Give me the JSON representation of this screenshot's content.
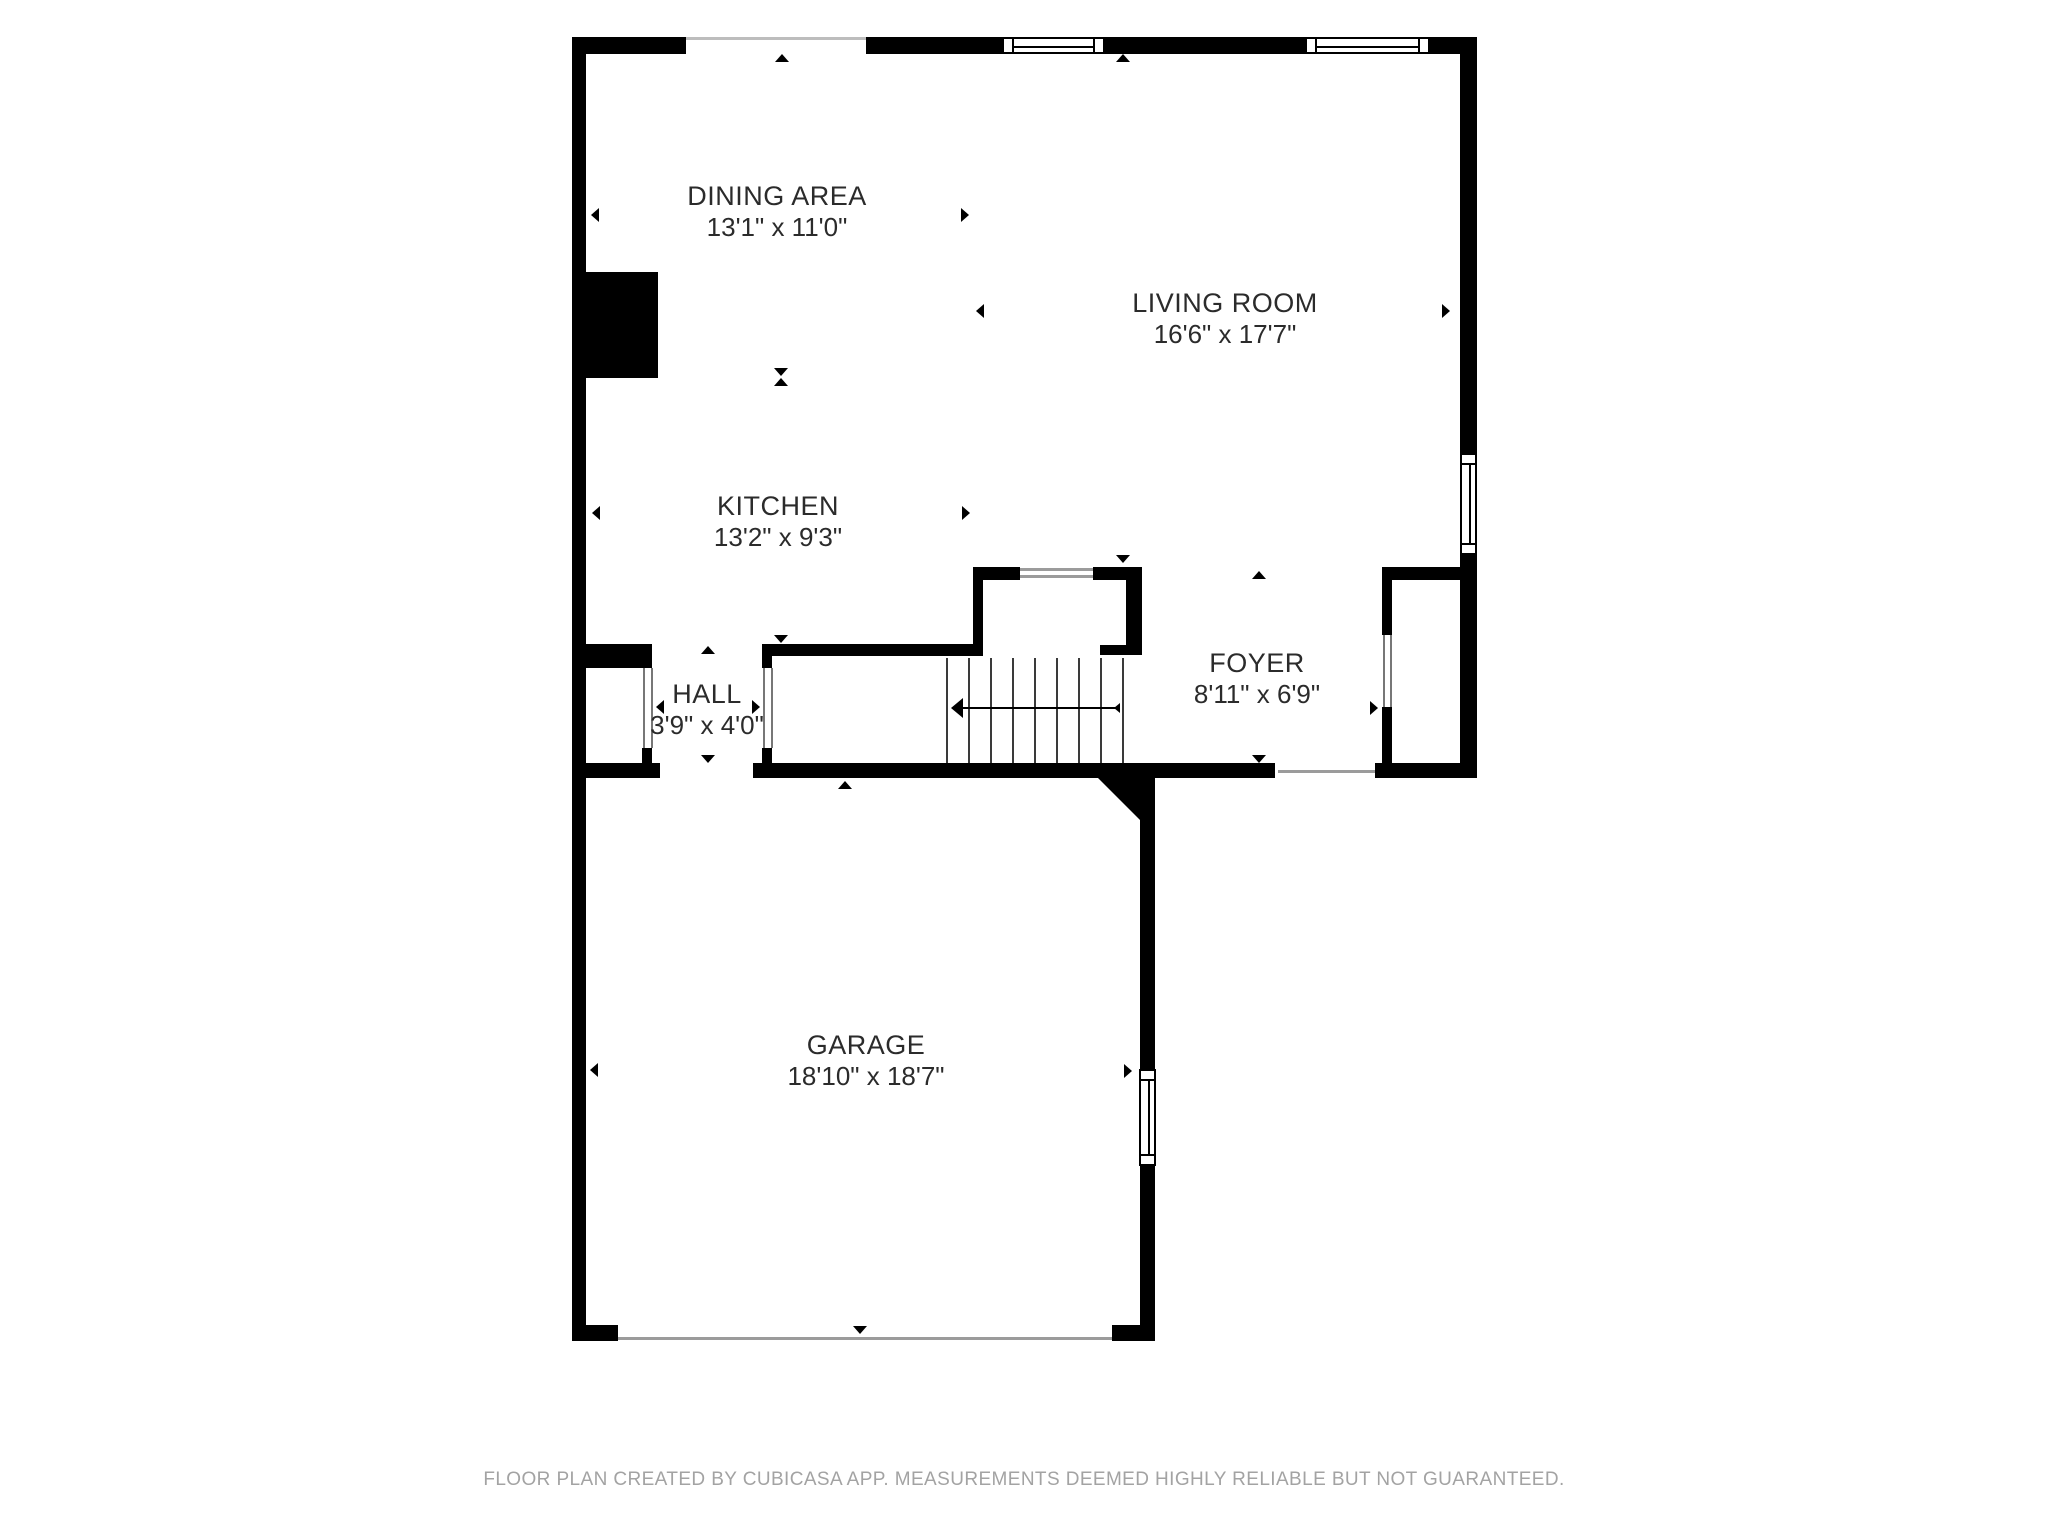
{
  "rooms": {
    "dining": {
      "name": "DINING AREA",
      "dimensions": "13'1\" x 11'0\""
    },
    "living": {
      "name": "LIVING ROOM",
      "dimensions": "16'6\" x 17'7\""
    },
    "kitchen": {
      "name": "KITCHEN",
      "dimensions": "13'2\" x 9'3\""
    },
    "hall": {
      "name": "HALL",
      "dimensions": "3'9\" x 4'0\""
    },
    "foyer": {
      "name": "FOYER",
      "dimensions": "8'11\" x 6'9\""
    },
    "garage": {
      "name": "GARAGE",
      "dimensions": "18'10\" x 18'7\""
    }
  },
  "footer": {
    "text": "FLOOR PLAN CREATED BY CUBICASA APP. MEASUREMENTS DEEMED HIGHLY RELIABLE BUT NOT GUARANTEED."
  },
  "colors": {
    "wall": "#000000",
    "label_text": "#2b2b2b",
    "footer_text": "#a3a3a3",
    "thin_line": "#9b9b9b"
  }
}
